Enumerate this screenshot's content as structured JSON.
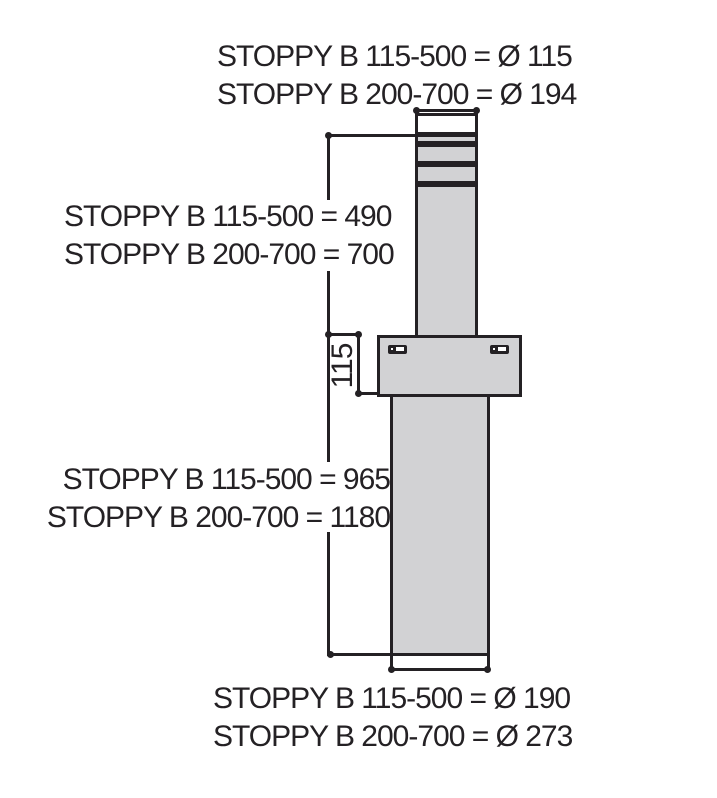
{
  "diagram": {
    "product": "STOPPY B",
    "type": "automatic-bollard-dimension-drawing",
    "colors": {
      "line": "#242124",
      "fill": "#d2d2d4",
      "background": "#ffffff",
      "text": "#242124"
    },
    "labels": {
      "top_diameter": {
        "line1": "STOPPY B 115-500 = Ø 115",
        "line2": "STOPPY B 200-700 = Ø 194"
      },
      "above_ground_height": {
        "line1": "STOPPY B 115-500 = 490",
        "line2": "STOPPY B 200-700 = 700"
      },
      "flange_height": "115",
      "total_height": {
        "line1": "STOPPY B 115-500 = 965",
        "line2": "STOPPY B 200-700 = 1180"
      },
      "underground_diameter": {
        "line1": "STOPPY B 115-500 = Ø 190",
        "line2": "STOPPY B 200-700 = Ø 273"
      }
    },
    "measurements": {
      "models": [
        "STOPPY B 115-500",
        "STOPPY B 200-700"
      ],
      "post_diameter_mm": [
        115,
        194
      ],
      "above_ground_height_mm": [
        490,
        700
      ],
      "flange_height_mm": 115,
      "total_height_mm": [
        965,
        1180
      ],
      "underground_casing_diameter_mm": [
        190,
        273
      ]
    }
  }
}
